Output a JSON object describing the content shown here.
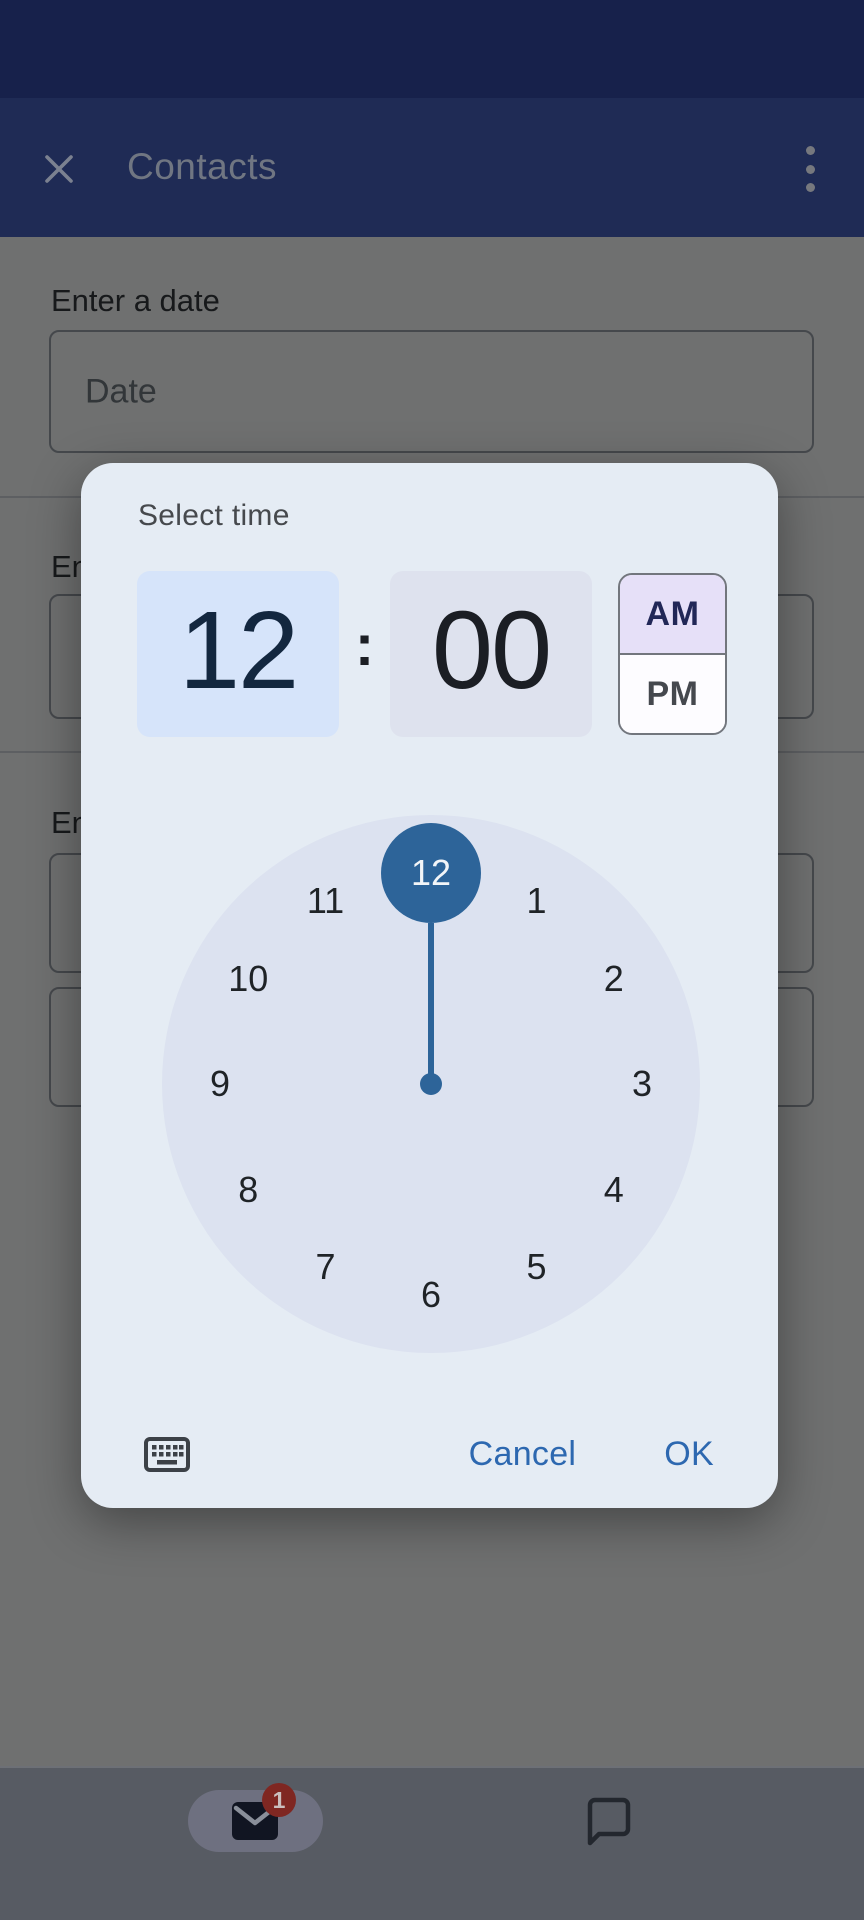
{
  "app_bar": {
    "title": "Contacts"
  },
  "form": {
    "date_label": "Enter a date",
    "date_placeholder": "Date",
    "section2_label": "En",
    "section3_label": "En"
  },
  "dialog": {
    "title": "Select time",
    "hour": "12",
    "colon": ":",
    "minute": "00",
    "am_label": "AM",
    "pm_label": "PM",
    "selected_period": "AM",
    "selected_hour": "12",
    "clock_numbers": [
      "12",
      "1",
      "2",
      "3",
      "4",
      "5",
      "6",
      "7",
      "8",
      "9",
      "10",
      "11"
    ],
    "cancel_label": "Cancel",
    "ok_label": "OK"
  },
  "nav": {
    "mail_badge": "1"
  },
  "colors": {
    "status_bar_bg": "#17214b",
    "app_bar_bg": "#1f2b55",
    "app_bar_text": "#707682",
    "scrim_bg": "#6f7070",
    "form_text": "#17191b",
    "field_border": "#45484c",
    "field_placeholder": "#323639",
    "divider": "#5d5f62",
    "dialog_bg": "#e5ecf4",
    "dialog_title": "#46494d",
    "hour_box_bg": "#d6e4fa",
    "hour_text": "#13273f",
    "minute_box_bg": "#dee2ee",
    "minute_text": "#1b1e24",
    "ampm_border": "#72767d",
    "am_bg": "#e6e0f8",
    "am_text": "#212757",
    "pm_bg": "#fdfcff",
    "pm_text": "#45484e",
    "clock_face_bg": "#dce2f0",
    "clock_number": "#1f2327",
    "selector_blue": "#2d6499",
    "selector_text": "#f2f5f8",
    "button_blue": "#2d68b0",
    "keyboard_icon": "#3c4147",
    "nav_bar_bg": "#575b63",
    "nav_divider": "#6d7076",
    "nav_pill_bg": "#6e7080",
    "mail_icon_bg": "#111522",
    "mail_flap": "#8a8f9a",
    "badge_bg": "#7f2722",
    "badge_text": "#cabfbe",
    "chat_icon": "#23272e",
    "close_icon": "#7b8190",
    "menu_icon": "#76787e"
  }
}
